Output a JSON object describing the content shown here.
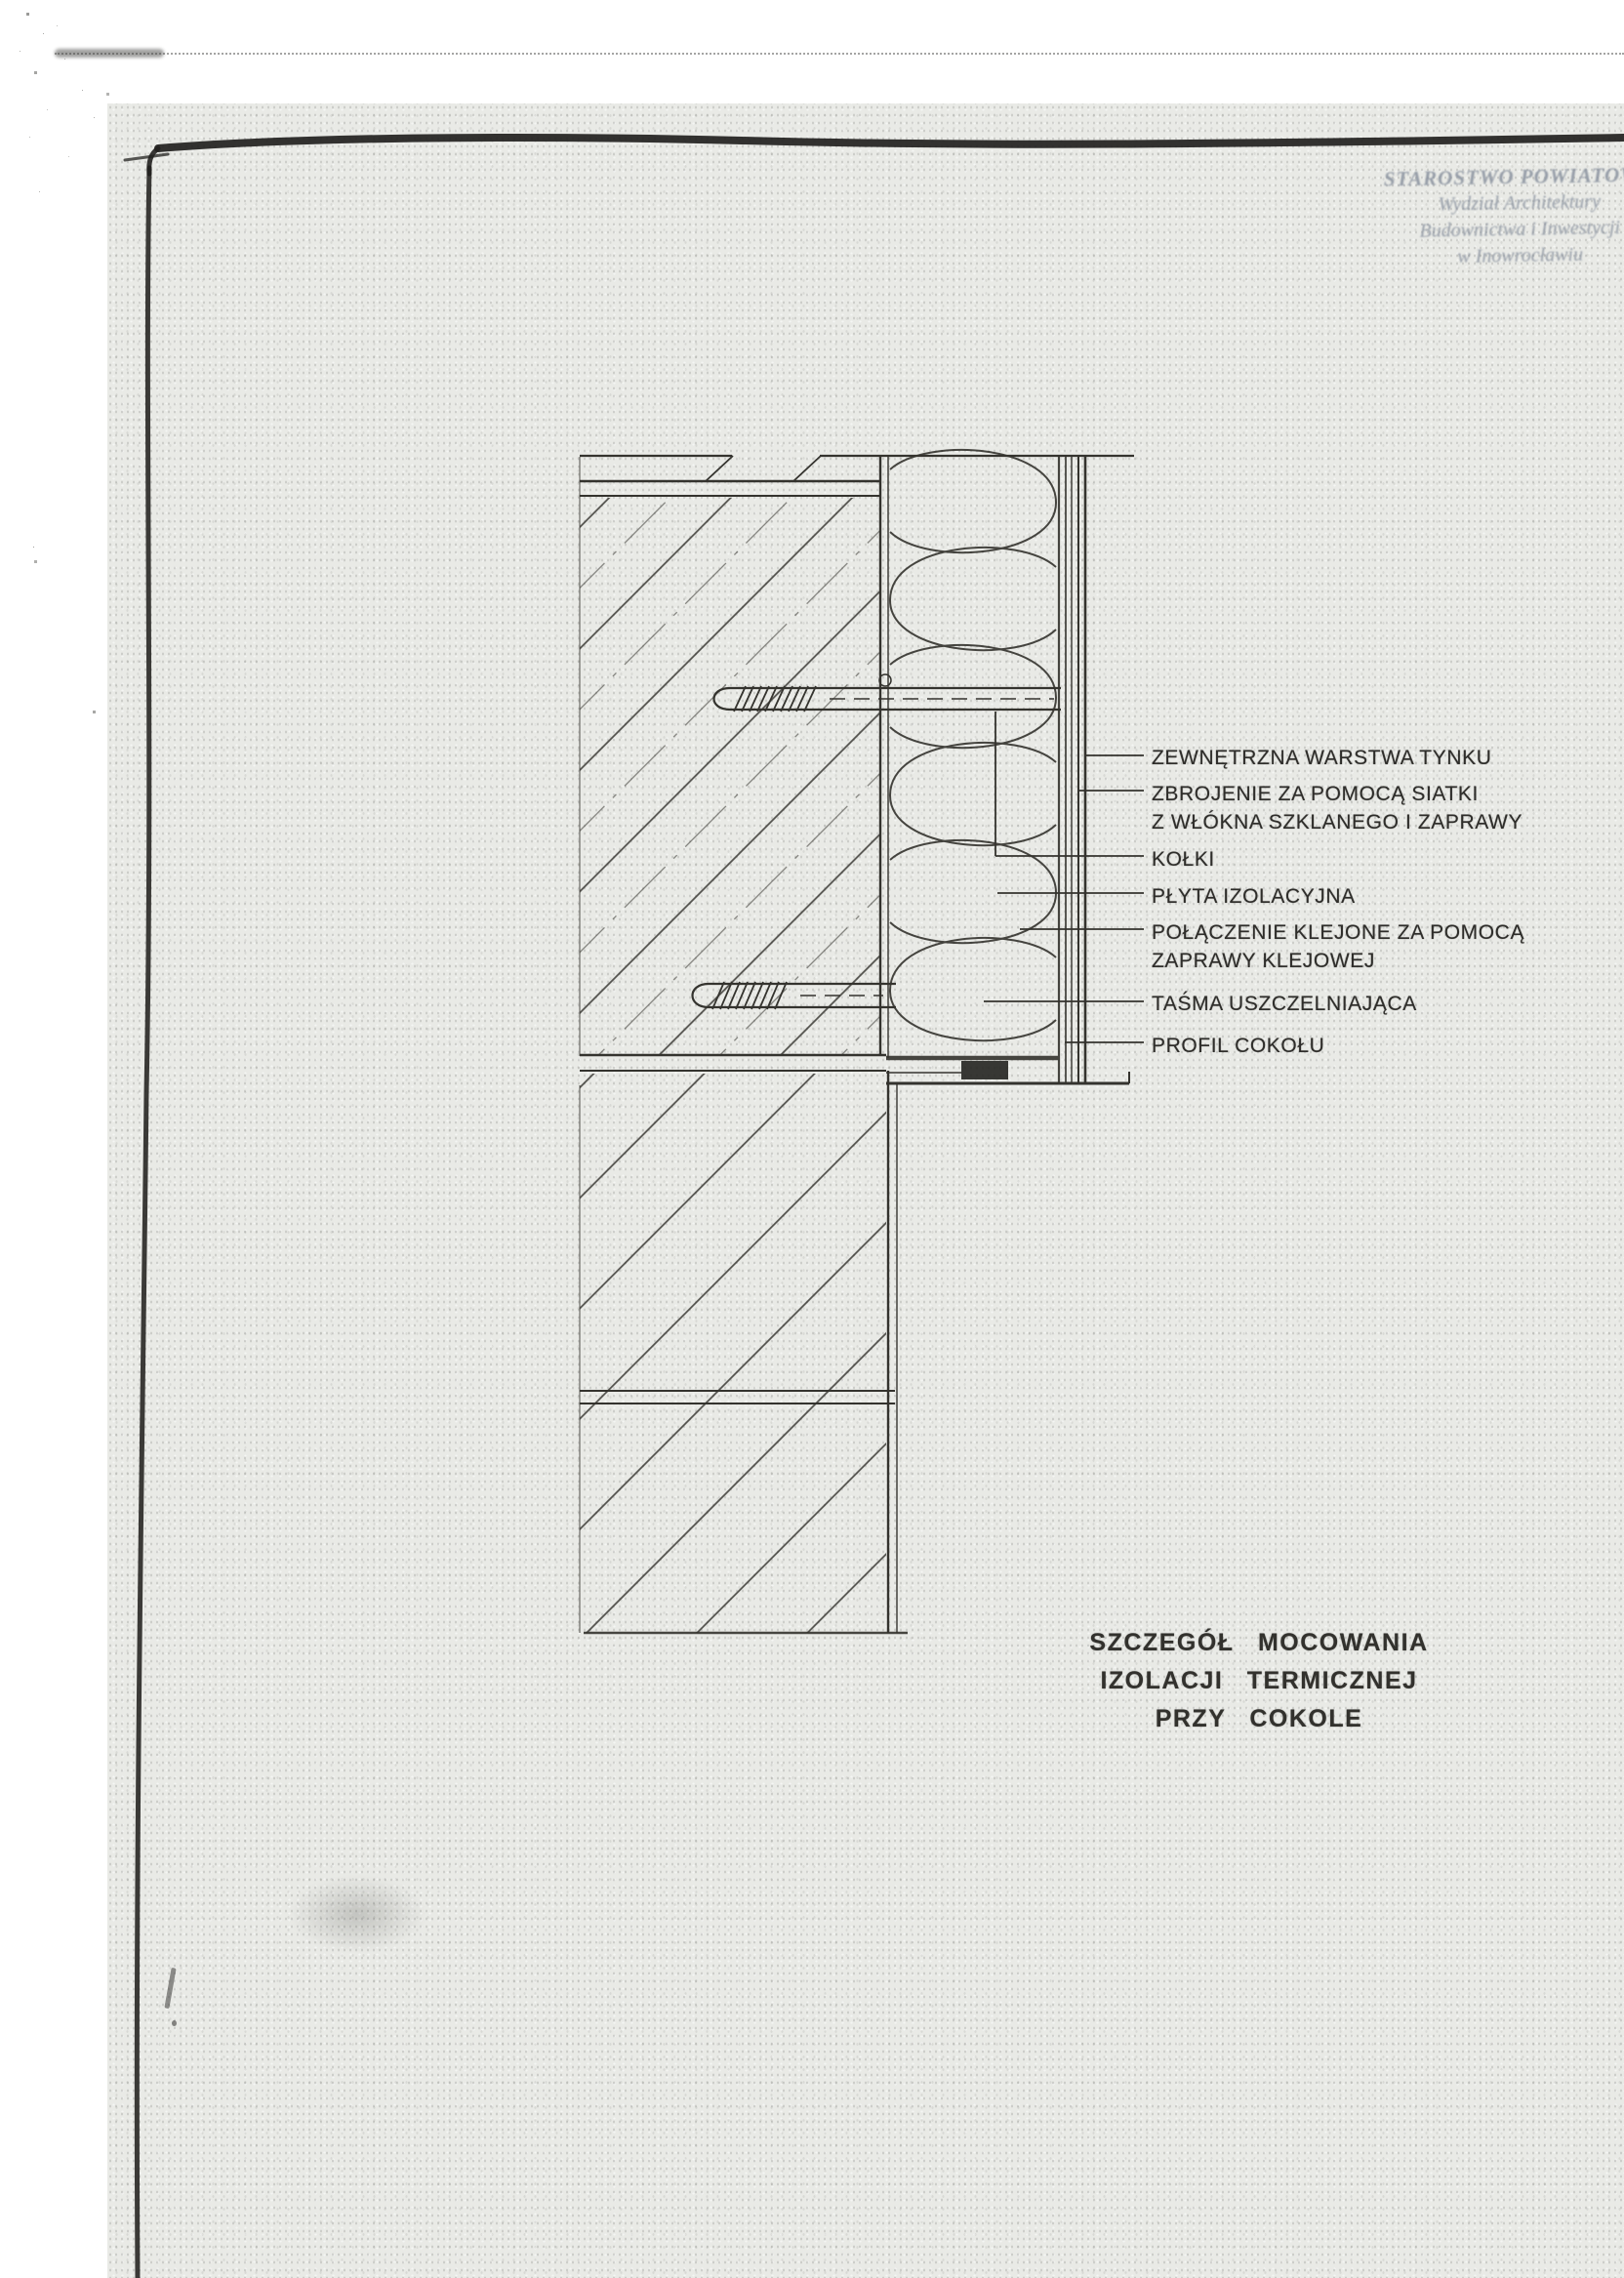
{
  "page": {
    "paper_color": "#e9eae6",
    "ink_color": "#34332e",
    "stamp_color": "#8d95a1"
  },
  "stamp": {
    "line1": "STAROSTWO POWIATOWE",
    "line2": "Wydział Architektury",
    "line3": "Budownictwa i Inwestycji",
    "line4": "w Inowrocławiu"
  },
  "labels": [
    {
      "line1": "ZEWNĘTRZNA WARSTWA TYNKU"
    },
    {
      "line1": "ZBROJENIE ZA POMOCĄ SIATKI",
      "line2": "Z WŁÓKNA SZKLANEGO I ZAPRAWY"
    },
    {
      "line1": "KOŁKI"
    },
    {
      "line1": "PŁYTA IZOLACYJNA"
    },
    {
      "line1": "POŁĄCZENIE KLEJONE ZA POMOCĄ",
      "line2": "ZAPRAWY KLEJOWEJ"
    },
    {
      "line1": "TAŚMA USZCZELNIAJĄCA"
    },
    {
      "line1": "PROFIL COKOŁU"
    }
  ],
  "title": {
    "line1": "SZCZEGÓŁ MOCOWANIA",
    "line2": "IZOLACJI TERMICZNEJ",
    "line3": "PRZY COKOLE"
  }
}
